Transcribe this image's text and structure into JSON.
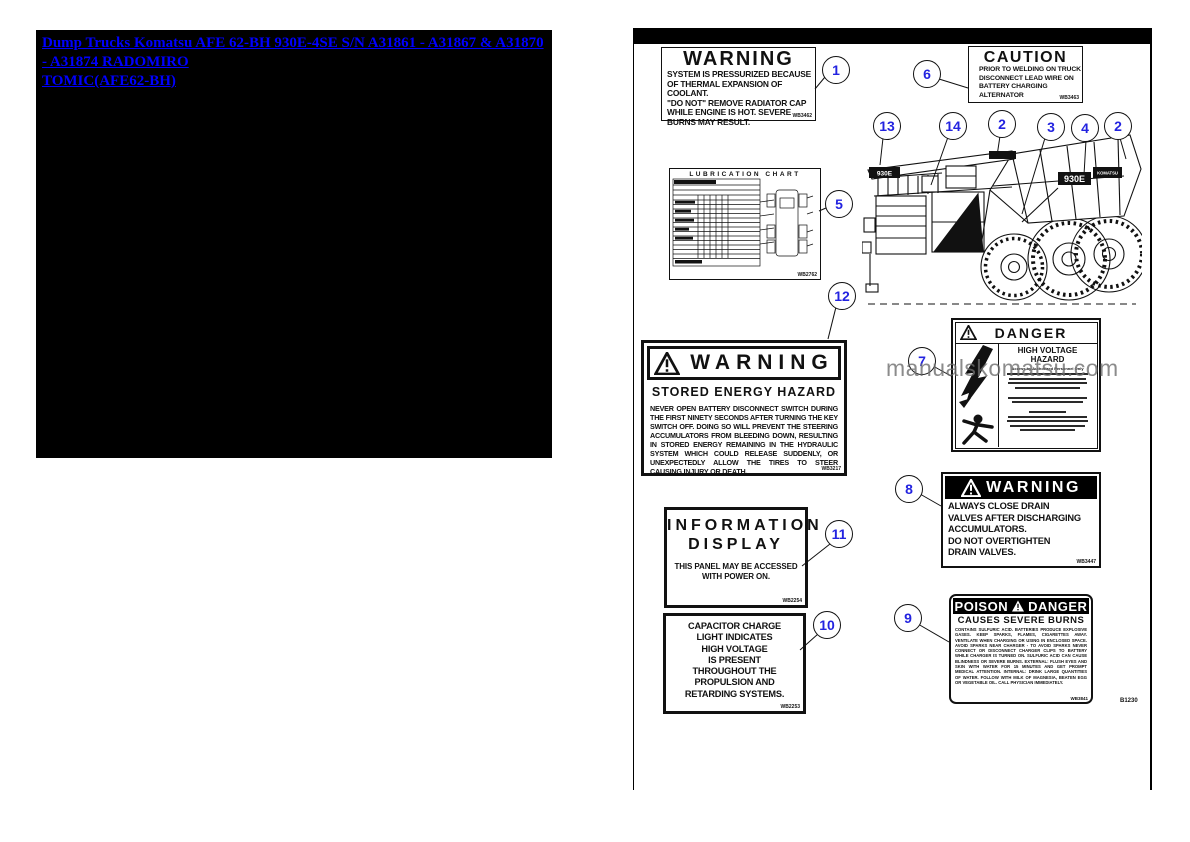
{
  "nav_link": {
    "line1": "Dump Trucks Komatsu AFE 62-BH 930E-4SE S/N A31861 - A31867 & A31870 - A31874 RADOMIRO",
    "line2": "TOMIC(AFE62-BH)"
  },
  "page": {
    "watermark": "manualskomatsu.com",
    "page_code": "B1230"
  },
  "decals": {
    "coolant": {
      "title": "WARNING",
      "lines": [
        "SYSTEM IS PRESSURIZED BECAUSE",
        "OF THERMAL EXPANSION OF COOLANT.",
        "\"DO NOT\" REMOVE RADIATOR CAP",
        "WHILE ENGINE IS HOT. SEVERE",
        "BURNS MAY RESULT."
      ],
      "code": "WB3462"
    },
    "caution": {
      "title": "CAUTION",
      "lines": [
        "PRIOR TO WELDING ON TRUCK",
        "DISCONNECT LEAD WIRE ON",
        "BATTERY CHARGING ALTERNATOR"
      ],
      "code": "WB3463"
    },
    "lube": {
      "title": "LUBRICATION CHART",
      "code": "WB2762"
    },
    "stored": {
      "header": "WARNING",
      "title": "STORED ENERGY HAZARD",
      "body": "NEVER OPEN BATTERY DISCONNECT SWITCH DURING THE FIRST NINETY SECONDS AFTER TURNING THE KEY SWITCH OFF.  DOING SO WILL PREVENT THE STEERING ACCUMULATORS FROM BLEEDING DOWN, RESULTING IN STORED ENERGY REMAINING IN THE HYDRAULIC SYSTEM WHICH COULD RELEASE SUDDENLY, OR UNEXPECTEDLY ALLOW THE TIRES TO STEER CAUSING INJURY OR DEATH.",
      "code": "WB3217"
    },
    "danger_hv": {
      "header": "DANGER",
      "title": "HIGH VOLTAGE HAZARD",
      "subtitle": "Access by Authorized Personnel Only"
    },
    "drain": {
      "header": "WARNING",
      "lines": [
        "ALWAYS CLOSE DRAIN",
        "VALVES AFTER DISCHARGING",
        "ACCUMULATORS.",
        "DO NOT OVERTIGHTEN",
        "DRAIN VALVES."
      ],
      "code": "WB3447"
    },
    "info": {
      "title_line1": "INFORMATION",
      "title_line2": "DISPLAY",
      "lines": [
        "THIS PANEL MAY BE ACCESSED",
        "WITH POWER ON."
      ],
      "code": "WB2254"
    },
    "capacitor": {
      "lines": [
        "CAPACITOR CHARGE",
        "LIGHT INDICATES",
        "HIGH VOLTAGE",
        "IS PRESENT",
        "THROUGHOUT THE",
        "PROPULSION AND",
        "RETARDING SYSTEMS."
      ],
      "code": "WB2253"
    },
    "poison": {
      "header_left": "POISON",
      "header_right": "DANGER",
      "title": "CAUSES SEVERE BURNS",
      "body": "CONTAINS SULFURIC ACID. BATTERIES PRODUCE EXPLOSIVE GASES. KEEP SPARKS, FLAMES, CIGARETTES AWAY. VENTILATE WHEN CHARGING OR USING IN ENCLOSED SPACE. AVOID SPARKS NEAR CHARGER - TO AVOID SPARKS NEVER CONNECT OR DISCONNECT CHARGER CLIPS TO BATTERY WHILE CHARGER IS TURNED ON. SULFURIC ACID CAN CAUSE BLINDNESS OR SEVERE BURNS. EXTERNAL: FLUSH EYES AND SKIN WITH WATER FOR 15 MINUTES AND GET PROMPT MEDICAL ATTENTION. INTERNAL: DRINK LARGE QUANTITIES OF WATER. FOLLOW WITH MILK OF MAGNESIA, BEATEN EGG OR VEGETABLE OIL. CALL PHYSICIAN IMMEDIATELY.",
      "code": "WB3841"
    }
  },
  "truck": {
    "front_decal": "930E",
    "body_decal": "930E",
    "brand_decal": "KOMATSU"
  },
  "callouts": {
    "c1": "1",
    "c6": "6",
    "c13": "13",
    "c14": "14",
    "c2a": "2",
    "c3": "3",
    "c4": "4",
    "c2b": "2",
    "c5": "5",
    "c12": "12",
    "c7": "7",
    "c8": "8",
    "c11": "11",
    "c10": "10",
    "c9": "9"
  }
}
